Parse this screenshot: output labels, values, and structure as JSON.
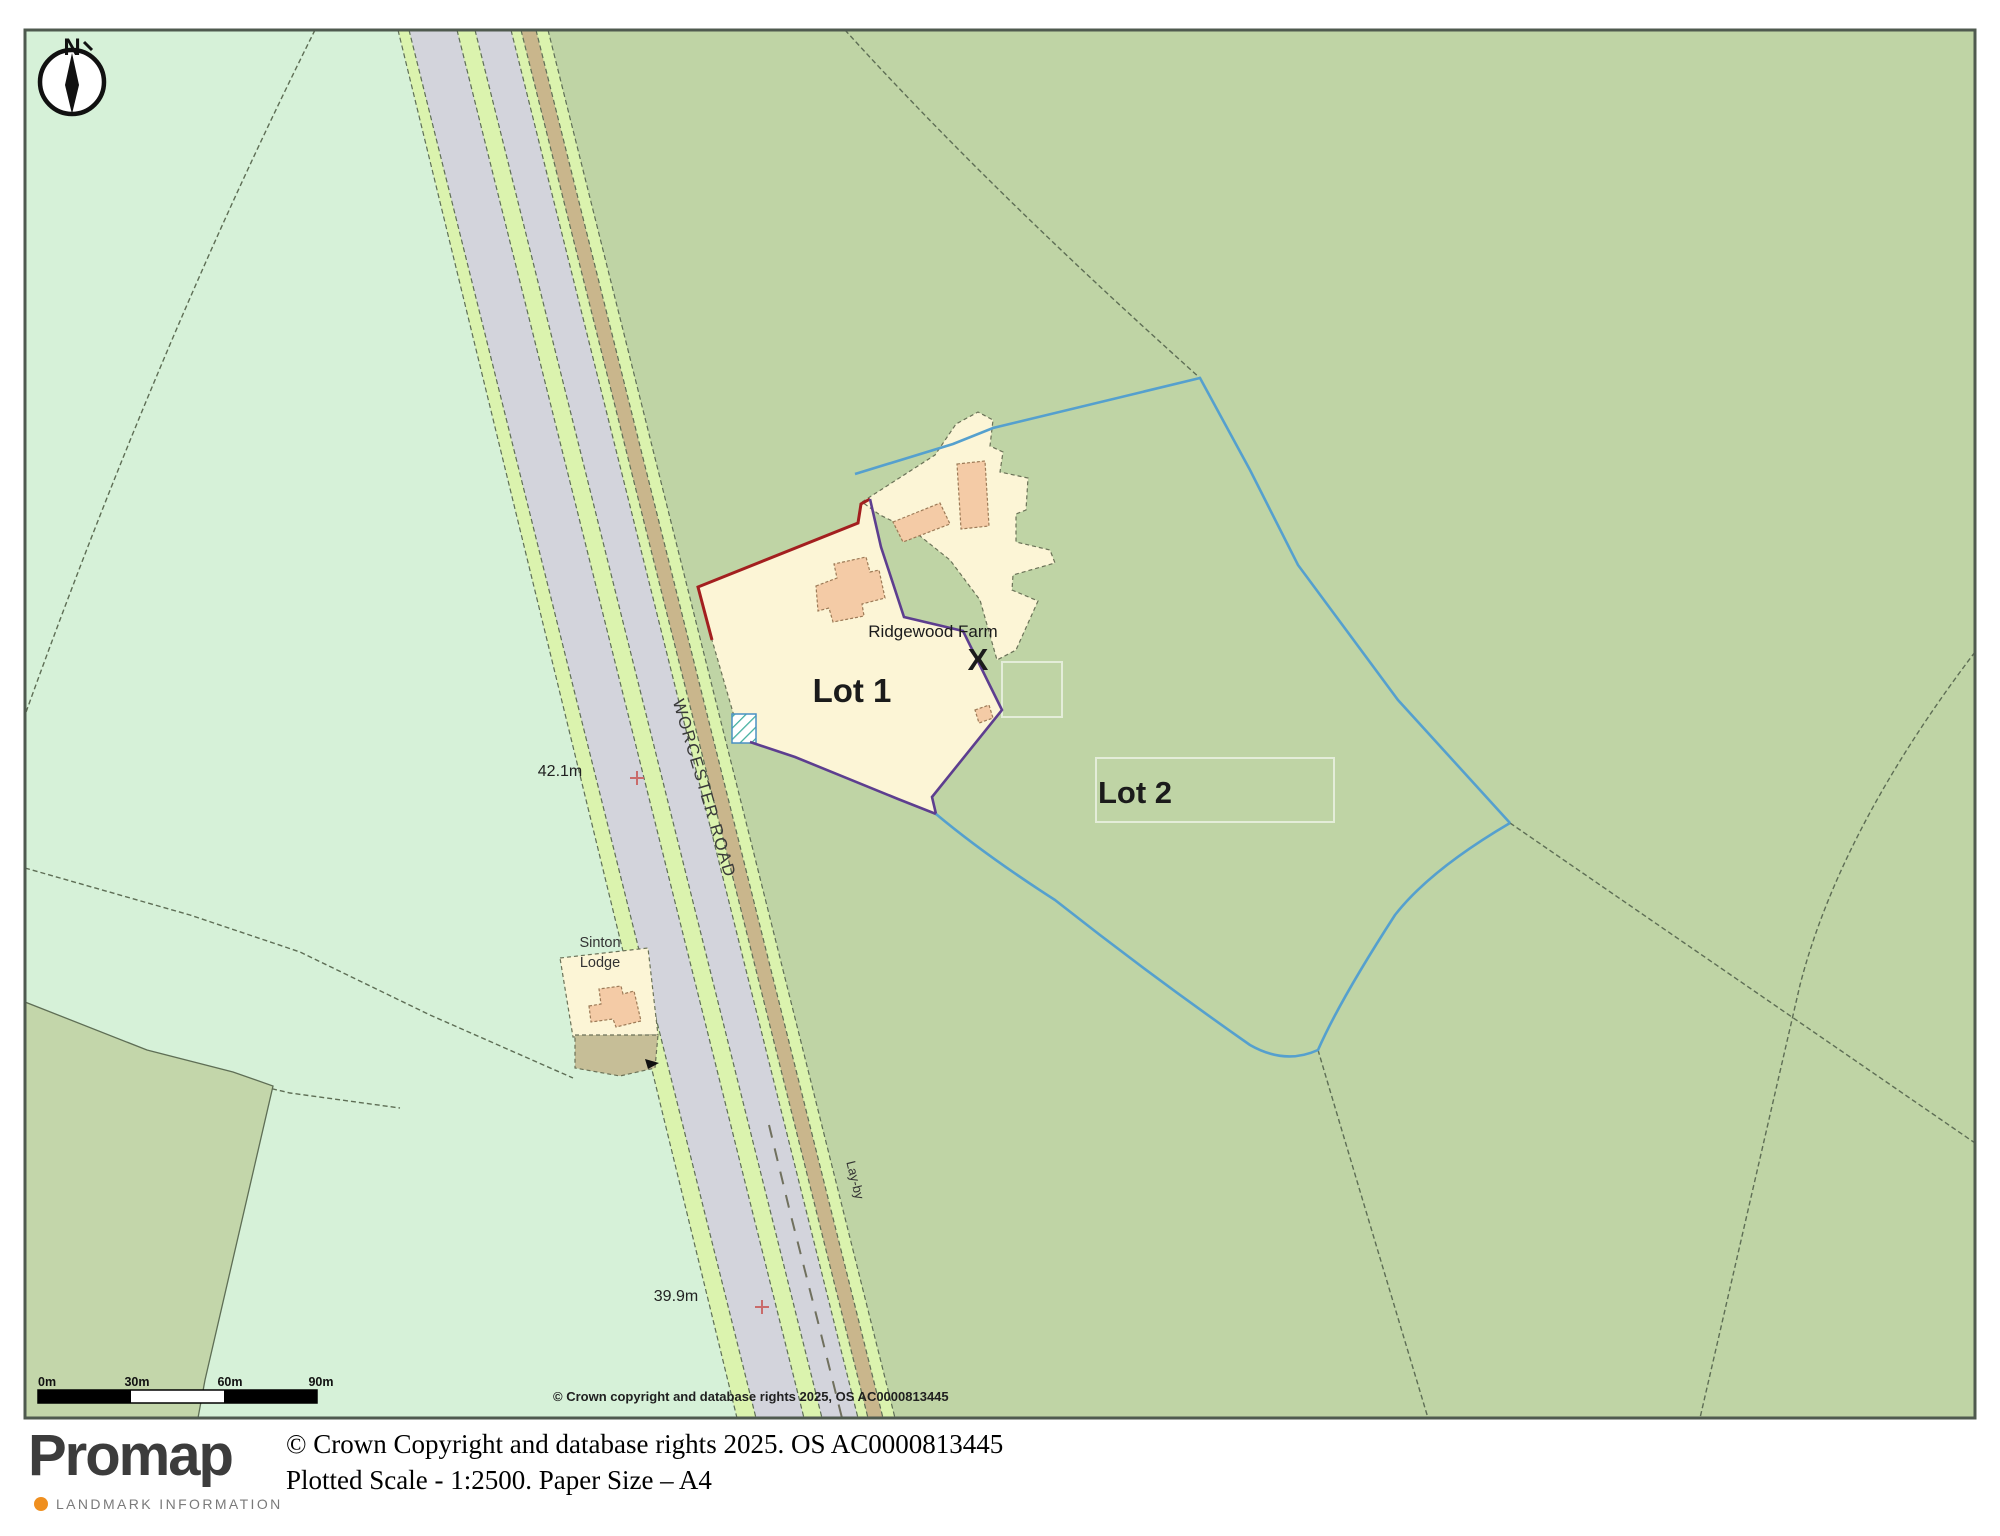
{
  "map": {
    "north_label": "N",
    "labels": {
      "lot1": "Lot 1",
      "lot2": "Lot 2",
      "farm_name": "Ridgewood Farm",
      "x_marker": "X",
      "sinton_line1": "Sinton",
      "sinton_line2": "Lodge",
      "road_name": "WORCESTER ROAD",
      "layby": "Lay-by",
      "spot_height_upper": "42.1m",
      "spot_height_lower": "39.9m"
    },
    "scale_bar": {
      "ticks": [
        "0m",
        "30m",
        "60m",
        "90m"
      ]
    },
    "copyright_inline": "© Crown copyright and database rights 2025, OS AC0000813445",
    "colors": {
      "lot1_outline": "#a31f1f",
      "lot2_outline": "#55a0ce",
      "shared_outline": "#5d3e8f",
      "field_light": "#d6f1d8",
      "field_dark": "#bfd4a5",
      "road_surface": "#d3d4dc",
      "verge": "#dbf3ae",
      "track": "#c9b68c",
      "parcel_cream": "#fcf5d6",
      "building_peach": "#f4cba6",
      "farmyard_brown": "#c6be97"
    }
  },
  "footer": {
    "logo_text": "Promap",
    "logo_subtext": "LANDMARK INFORMATION",
    "copyright_line": "© Crown Copyright and database rights 2025. OS AC0000813445",
    "scale_line": "Plotted Scale - 1:2500. Paper Size – A4"
  }
}
